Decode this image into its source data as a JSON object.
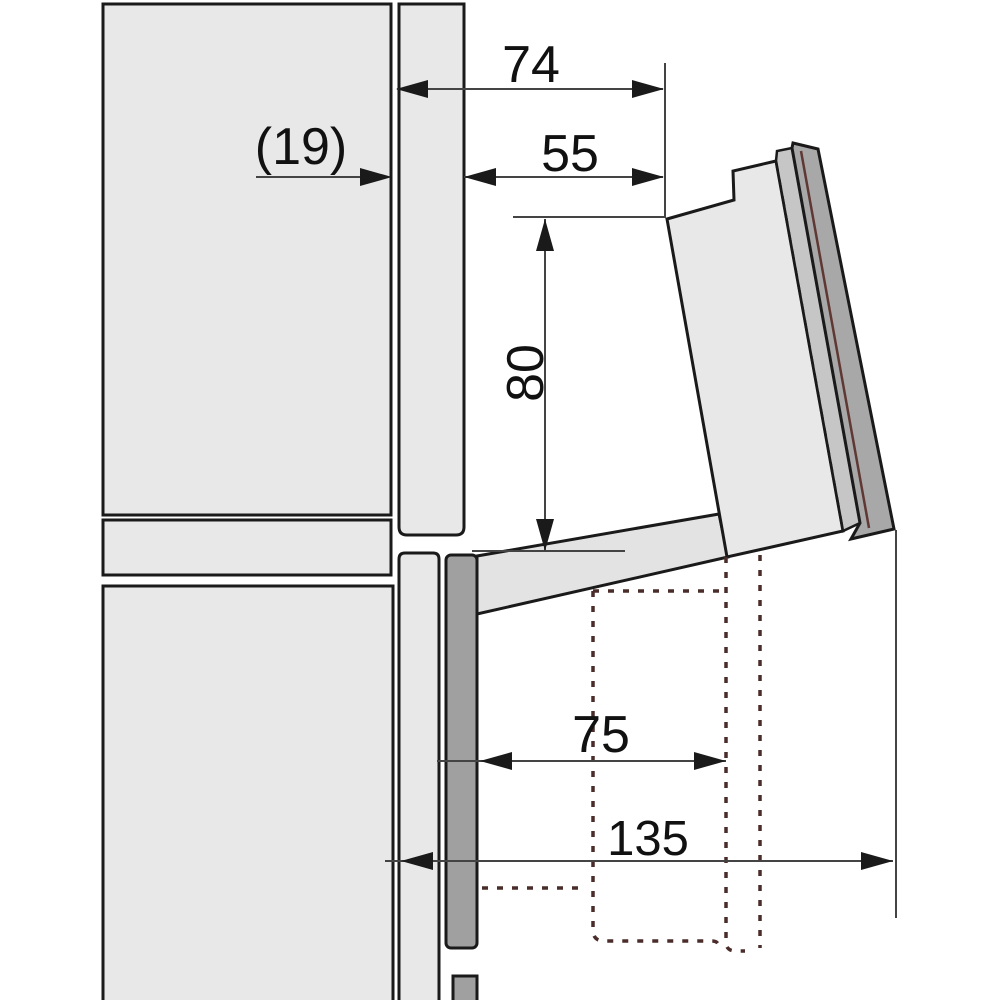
{
  "diagram": {
    "dims": {
      "d74": "74",
      "d55": "55",
      "d19": "(19)",
      "d80": "80",
      "d75": "75",
      "d135": "135"
    },
    "colors": {
      "panel_light": "#e8e8e8",
      "arm_gray": "#e3e3e3",
      "door_middle_gray": "#c6c6c6",
      "door_outer_gray": "#a8a8a8",
      "appliance_strip_gray": "#a0a0a0",
      "outline_black": "#1a1a1a",
      "dimension_line": "#444444",
      "hidden_outline_maroon": "#4a2d2a",
      "door_seal_red": "#5f3833"
    }
  }
}
